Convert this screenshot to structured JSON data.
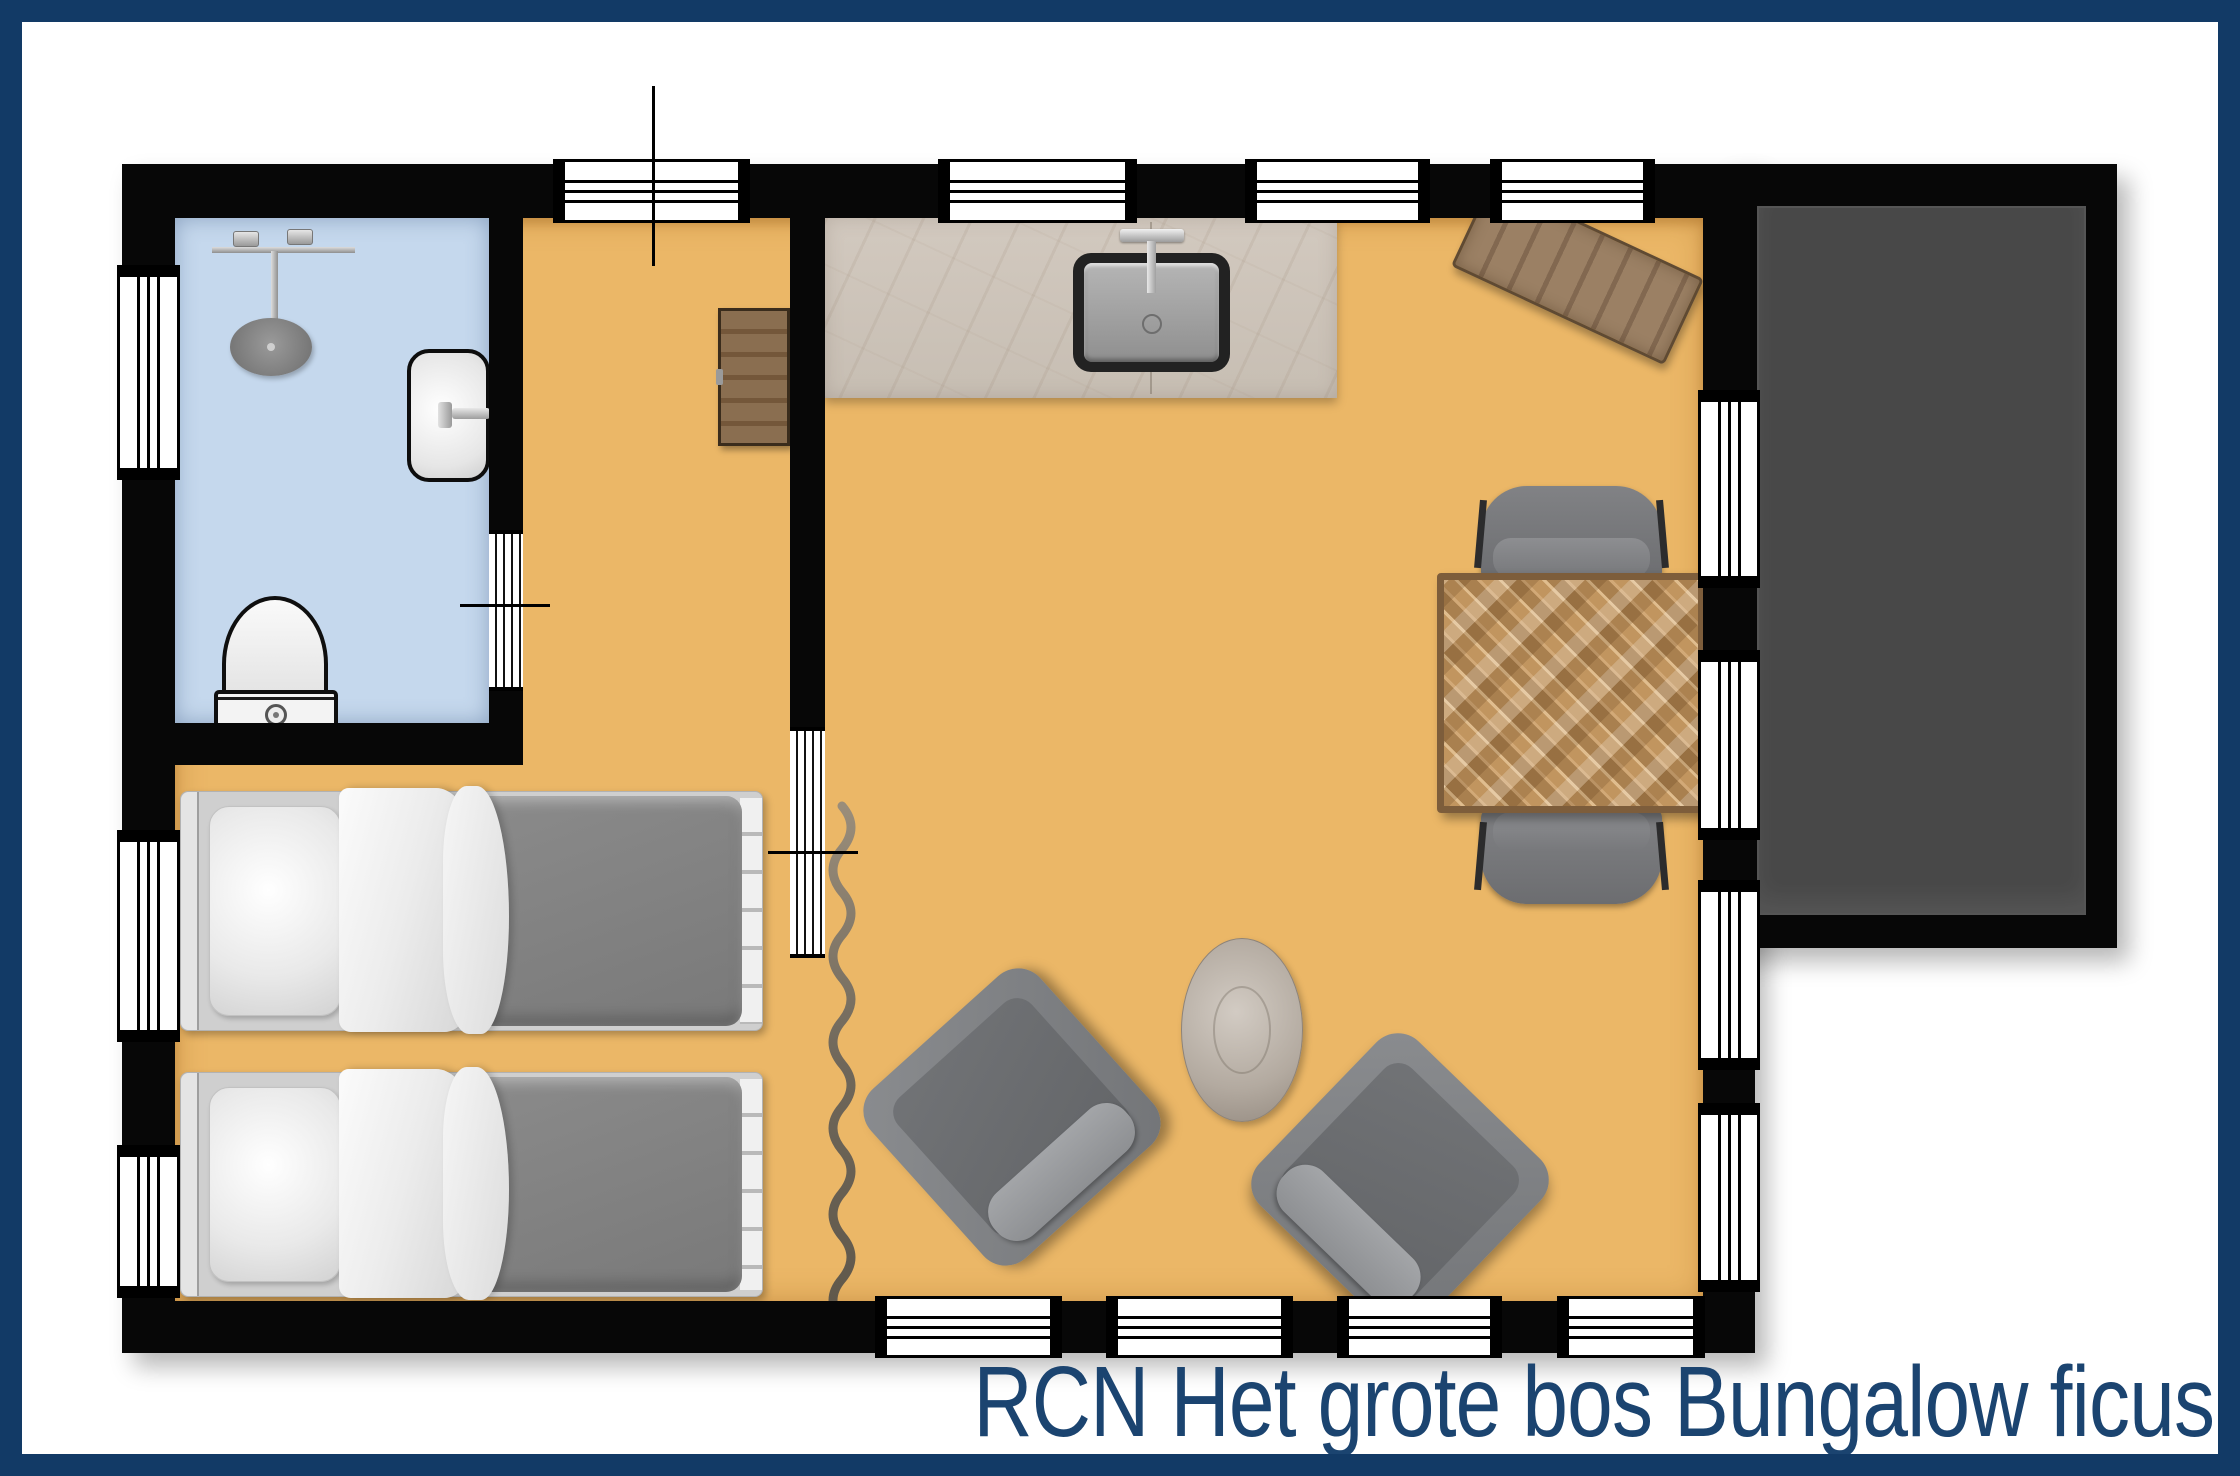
{
  "title": {
    "text": "RCN Het grote bos Bungalow ficus"
  },
  "colors": {
    "border-navy": "#123a66",
    "title-navy": "#1b4470",
    "wall-black": "#070707",
    "floor-orange": "#ebb767",
    "bathroom-blue": "#c5d8ed",
    "terrace-dark": "#484848",
    "counter-beige": "#ccc3b8",
    "cabinet-brown": "#84674a",
    "mat-brown": "#93785d",
    "table-wood": "#b98b5c",
    "chair-gray": "#7e8083",
    "duvet-gray": "#8b8b8b",
    "linen-white": "#f2f2f2",
    "side-table-taupe": "#b3aaa0",
    "divider-taupe": "#7d7265"
  }
}
